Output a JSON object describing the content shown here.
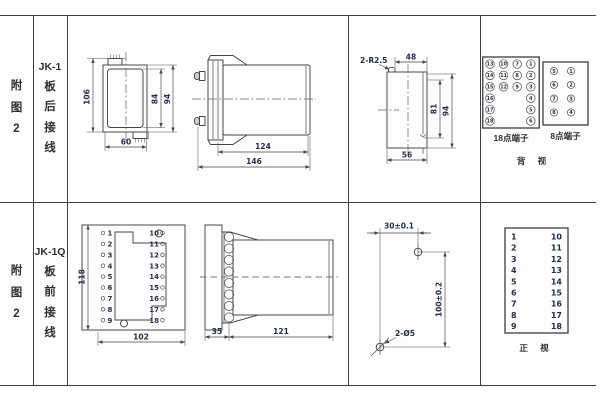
{
  "table": {
    "rows": [
      {
        "figure": [
          "附",
          "图",
          "2"
        ],
        "model": "JK-1",
        "wiring": [
          "板",
          "后",
          "接",
          "线"
        ],
        "front_view": {
          "height": "106",
          "inner_height": "84",
          "outer_height": "94",
          "width": "60"
        },
        "side_view": {
          "body_length": "124",
          "total_length": "146"
        },
        "cutout": {
          "radius_note": "2-R2.5",
          "top_width": "48",
          "inner_height": "81",
          "outer_height": "94",
          "bottom_width": "56"
        },
        "terminals_18": {
          "label": "18点端子",
          "grid": [
            [
              "13",
              "10",
              "7",
              "1"
            ],
            [
              "14",
              "11",
              "8",
              "2"
            ],
            [
              "15",
              "12",
              "9",
              "3"
            ],
            [
              "16",
              "",
              "",
              "4"
            ],
            [
              "17",
              "",
              "",
              "5"
            ],
            [
              "18",
              "",
              "",
              "6"
            ]
          ]
        },
        "terminals_8": {
          "label": "8点端子",
          "grid": [
            [
              "5",
              "1"
            ],
            [
              "6",
              "2"
            ],
            [
              "7",
              "3"
            ],
            [
              "8",
              "4"
            ]
          ]
        },
        "view_label": "背 视"
      },
      {
        "figure": [
          "附",
          "图",
          "2"
        ],
        "model": "JK-1Q",
        "wiring": [
          "板",
          "前",
          "接",
          "线"
        ],
        "front_view": {
          "height": "118",
          "width": "102",
          "left_terminals": [
            "1",
            "2",
            "3",
            "4",
            "5",
            "6",
            "7",
            "8",
            "9"
          ],
          "right_terminals": [
            "10",
            "11",
            "12",
            "13",
            "14",
            "15",
            "16",
            "17",
            "18"
          ]
        },
        "side_view": {
          "flange_depth": "35",
          "body_length": "121"
        },
        "drill_plan": {
          "hole_spacing_h": "30±0.1",
          "hole_spacing_v": "100±0.2",
          "hole_note": "2-Ø5"
        },
        "terminal_table": {
          "left": [
            "1",
            "2",
            "3",
            "4",
            "5",
            "6",
            "7",
            "8",
            "9"
          ],
          "right": [
            "10",
            "11",
            "12",
            "13",
            "14",
            "15",
            "16",
            "17",
            "18"
          ],
          "view_label": "正 视"
        }
      }
    ]
  }
}
